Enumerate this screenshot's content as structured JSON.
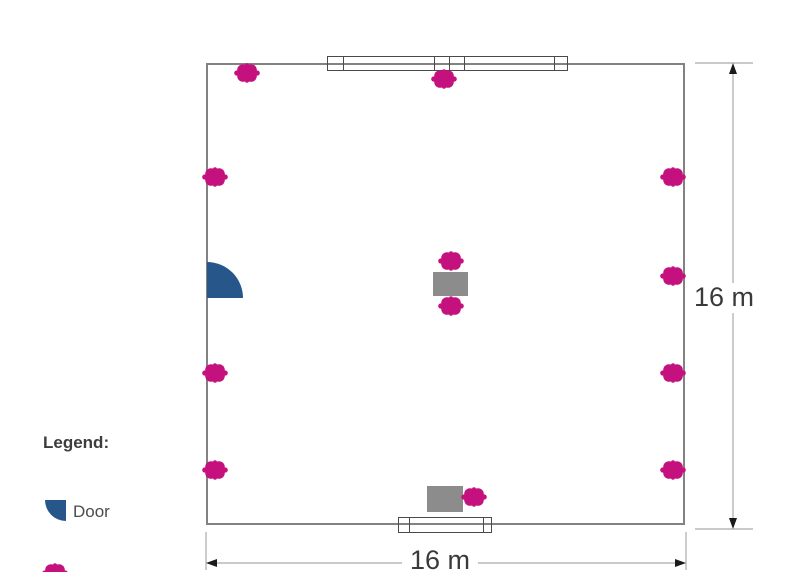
{
  "legend": {
    "title": "Legend:",
    "door_label": "Door"
  },
  "dimensions": {
    "height_label": "16 m",
    "width_label": "16 m"
  },
  "colors": {
    "marker": "#C4117E",
    "door": "#27568B",
    "table": "#8C8C8C",
    "wall": "#828282",
    "window_line": "#4A4A4A",
    "dim_line": "#ABABAB",
    "arrow": "#1A1A1A",
    "text": "#3A3A3A"
  },
  "floorplan": {
    "room": {
      "x": 206,
      "y": 63,
      "width": 479,
      "height": 462
    },
    "door": {
      "x": 207,
      "y": 262,
      "radius": 36
    },
    "windows": [
      {
        "side": "top",
        "x": 327,
        "y": 56,
        "width": 241,
        "height": 15,
        "dividers": [
          15,
          106,
          121,
          136,
          226
        ]
      },
      {
        "side": "bottom",
        "x": 398,
        "y": 517,
        "width": 94,
        "height": 16,
        "dividers": [
          10,
          84
        ]
      }
    ],
    "tables": [
      {
        "x": 433,
        "y": 272,
        "width": 35,
        "height": 24
      },
      {
        "x": 427,
        "y": 486,
        "width": 36,
        "height": 26
      }
    ],
    "marker_size": {
      "width": 26,
      "height": 20
    },
    "markers": [
      {
        "cx": 247,
        "cy": 73
      },
      {
        "cx": 444,
        "cy": 79
      },
      {
        "cx": 215,
        "cy": 177
      },
      {
        "cx": 673,
        "cy": 177
      },
      {
        "cx": 451,
        "cy": 261
      },
      {
        "cx": 673,
        "cy": 276
      },
      {
        "cx": 451,
        "cy": 306
      },
      {
        "cx": 215,
        "cy": 373
      },
      {
        "cx": 673,
        "cy": 373
      },
      {
        "cx": 215,
        "cy": 470
      },
      {
        "cx": 673,
        "cy": 470
      },
      {
        "cx": 474,
        "cy": 497
      }
    ],
    "legend_partial_marker": {
      "cx": 55,
      "cy": 573
    }
  }
}
